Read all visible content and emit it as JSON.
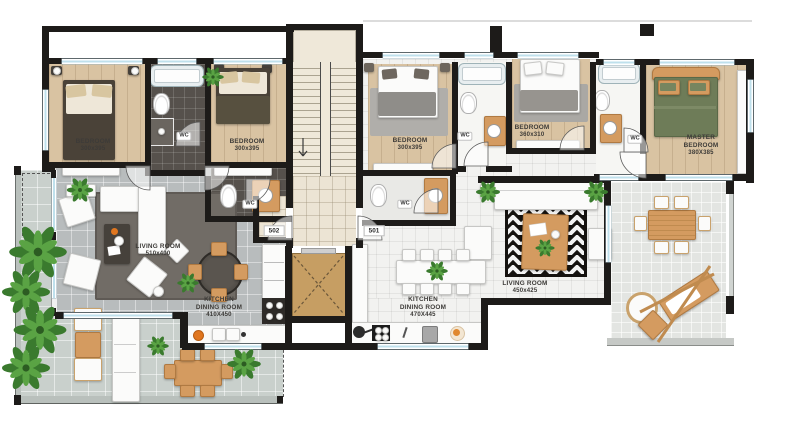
{
  "title": "Apartment floor plan - units 502 and 501",
  "unit_labels": {
    "left": "502",
    "right": "501"
  },
  "wc_label": "WC",
  "rooms": {
    "bedroom1": {
      "name": "BEDROOM",
      "dims": "300x395"
    },
    "bedroom2": {
      "name": "BEDROOM",
      "dims": "300x395"
    },
    "living_502": {
      "name": "LIVING ROOM",
      "dims": "510x400"
    },
    "kitchen_502": {
      "line1": "KITCHEN",
      "line2": "DINING ROOM",
      "dims": "410X450"
    },
    "bedroom3": {
      "name": "BEDROOM",
      "dims": "300x395"
    },
    "bedroom4": {
      "name": "BEDROOM",
      "dims": "360x310"
    },
    "master_bedroom": {
      "line1": "MASTER",
      "line2": "BEDROOM",
      "dims": "380X385"
    },
    "living_501": {
      "name": "LIVING ROOM",
      "dims": "450x425"
    },
    "kitchen_501": {
      "line1": "KITCHEN",
      "line2": "DINING ROOM",
      "dims": "470X445"
    }
  },
  "colors": {
    "wall": "#1d1b19",
    "wood_floor": "#d9c3a2",
    "dark_tile": "#56514c",
    "gray_tile": "#b8bcbd",
    "white_tile": "#f2f2f0",
    "hall_tile": "#ece4d4",
    "terrace": "#c9d0cc",
    "balcony": "#e3e5e2",
    "elevator_cab": "#c69e63",
    "window_glass": "#bfe0ec",
    "wood_furniture": "#d49b60",
    "plant_green": "#3e7c31",
    "rug_dark": "#716c66",
    "accent_orange": "#e0761f"
  }
}
